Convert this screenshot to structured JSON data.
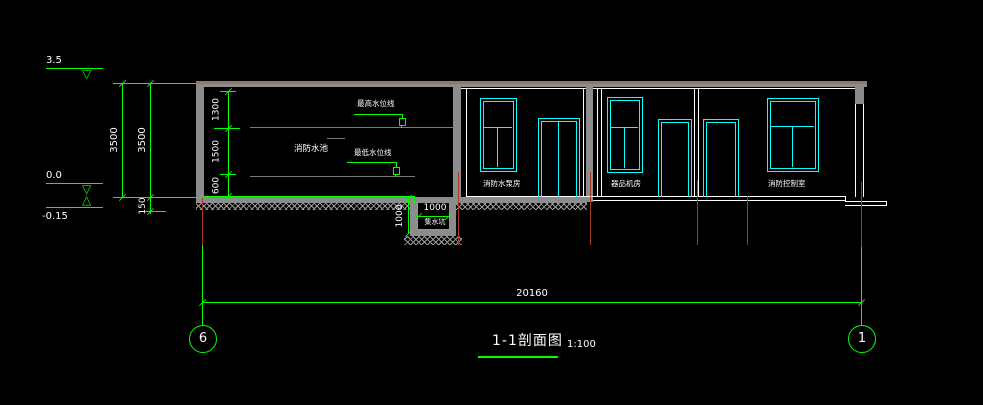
{
  "title": {
    "name": "1-1剖面图",
    "scale": "1:100"
  },
  "elevations": {
    "roof": "3.5",
    "zero": "0.0",
    "minus": "-0.15"
  },
  "dims": {
    "overall": "20160",
    "height_outer": "3500",
    "height_inner": "3500",
    "slab": "150",
    "top_space": "1300",
    "mid_space": "1500",
    "bottom_space": "600",
    "pit_width": "1000",
    "pit_depth": "1000"
  },
  "labels": {
    "tank": "消防水池",
    "high_water": "最高水位线",
    "low_water": "最低水位线",
    "sump": "集水坑",
    "room1": "消防水泵房",
    "room2": "器品机房",
    "room3": "消防控制室"
  },
  "axes": {
    "left": "6",
    "right": "1"
  },
  "colors": {
    "background": "#000000",
    "dimension_green": "#00ff00",
    "fixture_cyan": "#00ffff",
    "wall_gray": "#8c8c8c",
    "slab_tan": "#8f7b5f",
    "axis_red": "#a33a28",
    "text_white": "#ffffff"
  }
}
